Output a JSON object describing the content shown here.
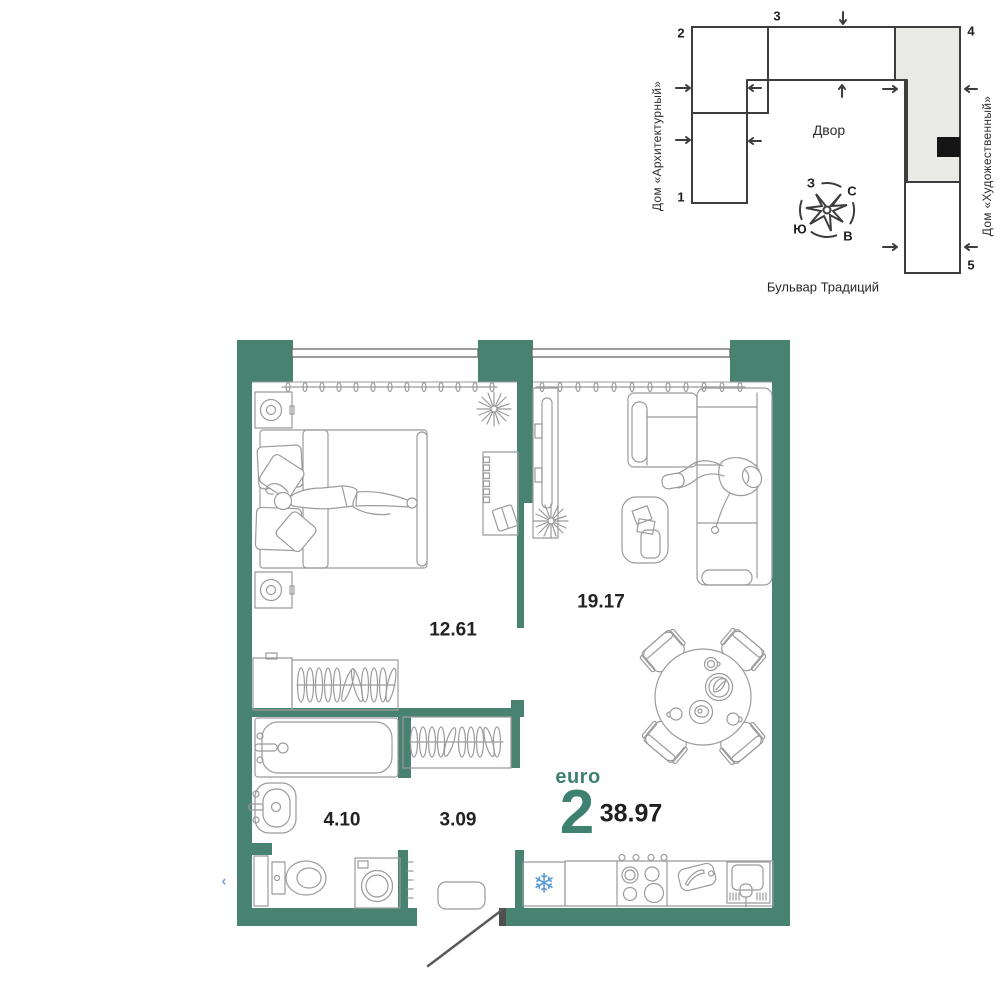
{
  "site_plan": {
    "courtyard_label": "Двор",
    "street_label": "Бульвар Традиций",
    "building_left_label": "Дом «Архитектурный»",
    "building_right_label": "Дом «Художественный»",
    "section_numbers": [
      "1",
      "2",
      "3",
      "4",
      "5"
    ],
    "compass": {
      "north": "С",
      "south": "Ю",
      "west": "З",
      "east": "В"
    },
    "highlighted_section_fill": "#e9e9e6",
    "apartment_marker_color": "#151515"
  },
  "floor_plan": {
    "wall_color": "#488271",
    "accent_text_color": "#3f8170",
    "rooms": [
      {
        "name": "bedroom",
        "area": "12.61"
      },
      {
        "name": "living-kitchen",
        "area": "19.17"
      },
      {
        "name": "bathroom",
        "area": "4.10"
      },
      {
        "name": "hallway",
        "area": "3.09"
      }
    ],
    "apartment": {
      "type_label": "euro",
      "rooms_count": "2",
      "total_area": "38.97"
    },
    "icons": {
      "fridge_snowflake": "❄",
      "fridge_snowflake_color": "#5b9bd5",
      "entrance_chevron": "‹",
      "entrance_chevron_color": "#7aa3da"
    }
  }
}
